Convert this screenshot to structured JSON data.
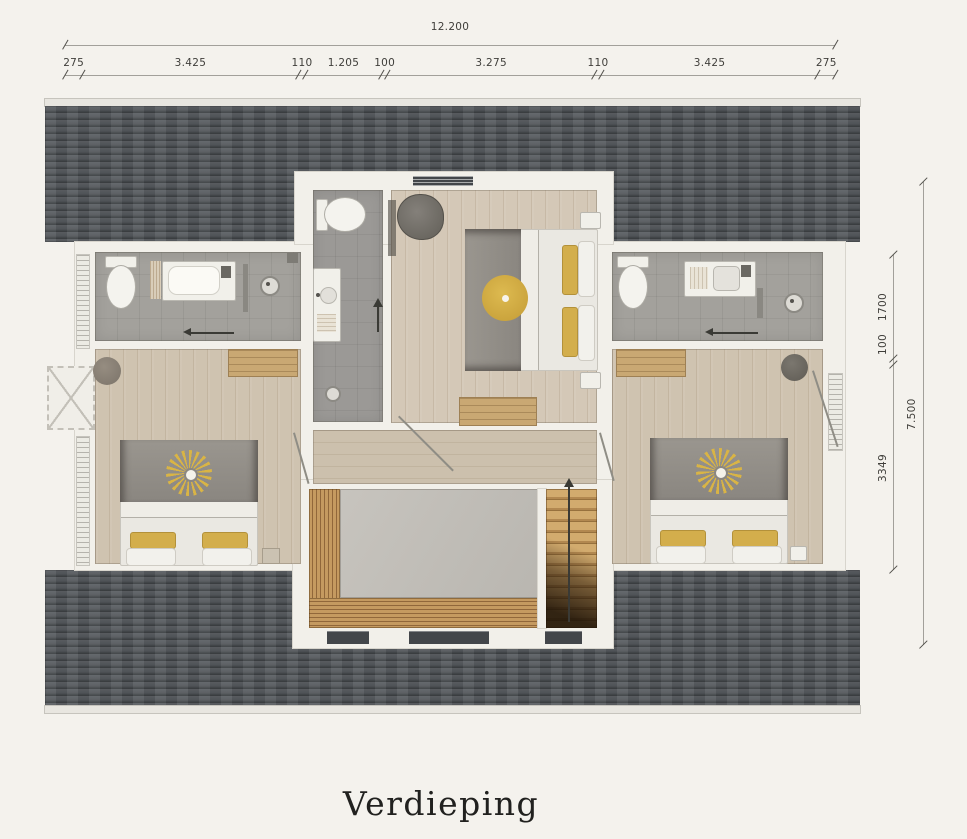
{
  "page": {
    "title_label": "Verdieping",
    "background": "#f4f2ed"
  },
  "dimensions": {
    "top": {
      "total_label": "12.200",
      "total_mm": 12200,
      "segments": [
        {
          "label": "275",
          "mm": 275
        },
        {
          "label": "3.425",
          "mm": 3425
        },
        {
          "label": "110",
          "mm": 110
        },
        {
          "label": "1.205",
          "mm": 1205
        },
        {
          "label": "100",
          "mm": 100
        },
        {
          "label": "3.275",
          "mm": 3275
        },
        {
          "label": "110",
          "mm": 110
        },
        {
          "label": "3.425",
          "mm": 3425
        },
        {
          "label": "275",
          "mm": 275
        }
      ]
    },
    "right": {
      "total_label": "7.500",
      "total_mm": 7500,
      "segments": [
        {
          "label": "1700",
          "mm": 1700
        },
        {
          "label": "100",
          "mm": 100
        },
        {
          "label": "3349",
          "mm": 3349
        }
      ]
    }
  },
  "colors": {
    "roof": "#4e5256",
    "wood_floor": "#cfc3b0",
    "tile_floor": "#a3a19c",
    "void_gray": "#c1beb8",
    "wood_slats": "#b48a55",
    "accent_yellow": "#d3ae4c",
    "bed_gray": "#8e8a84"
  }
}
